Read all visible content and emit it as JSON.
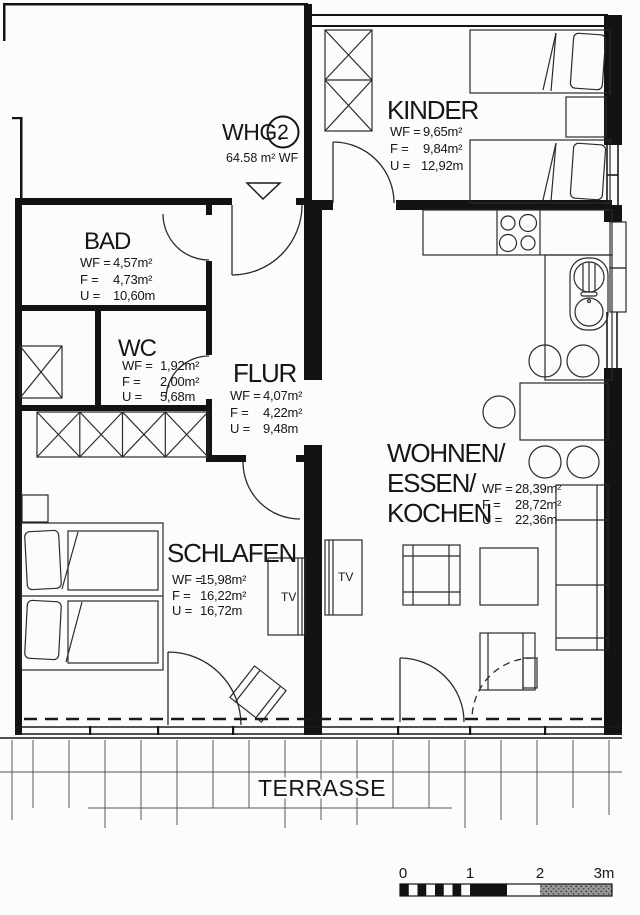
{
  "title": {
    "prefix": "WHG.",
    "number": "2",
    "area": "64.58 m² WF"
  },
  "labels": {
    "wf_key": "WF =",
    "f_key": "F =",
    "u_key": "U =",
    "tv": "TV",
    "terrasse": "TERRASSE"
  },
  "rooms": [
    {
      "id": "kinder",
      "name": "KINDER",
      "wf": "9,65m²",
      "f": "9,84m²",
      "u": "12,92m"
    },
    {
      "id": "bad",
      "name": "BAD",
      "wf": "4,57m²",
      "f": "4,73m²",
      "u": "10,60m"
    },
    {
      "id": "wc",
      "name": "WC",
      "wf": "1,92m²",
      "f": "2,00m²",
      "u": "5,68m"
    },
    {
      "id": "flur",
      "name": "FLUR",
      "wf": "4,07m²",
      "f": "4,22m²",
      "u": "9,48m"
    },
    {
      "id": "wohnen",
      "name_lines": [
        "WOHNEN/",
        "ESSEN/",
        "KOCHEN"
      ],
      "wf": "28,39m²",
      "f": "28,72m²",
      "u": "22,36m"
    },
    {
      "id": "schlafen",
      "name": "SCHLAFEN",
      "wf": "15,98m²",
      "f": "16,22m²",
      "u": "16,72m"
    }
  ],
  "scale_bar": {
    "ticks": [
      "0",
      "1",
      "2",
      "3m"
    ]
  },
  "colors": {
    "paper": "#fcfcfa",
    "line": "#131313"
  }
}
